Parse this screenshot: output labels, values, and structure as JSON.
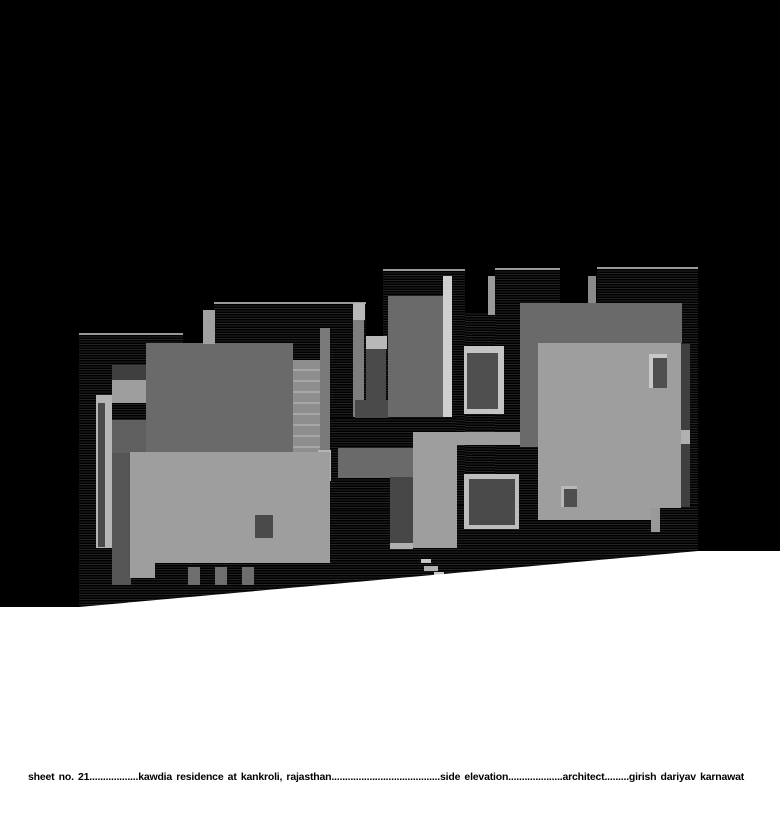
{
  "title_block": {
    "text": "sheet no. 21..................kawdia residence at kankroli, rajasthan........................................side elevation....................architect.........girish dariyav karnawat",
    "sheet_label": "sheet no. 21",
    "project": "kawdia residence at kankroli, rajasthan",
    "view": "side elevation",
    "role_label": "architect",
    "architect_name": "girish dariyav karnawat"
  },
  "drawing": {
    "colors": {
      "background": "#000000",
      "edge": "#9a9a9a",
      "ground_white": "#ffffff",
      "mid_gray": "#6a6a6a",
      "light_gray": "#9e9e9e",
      "lighter_gray": "#b5b5b5",
      "bright_gray": "#cfcfcf",
      "dark_gray": "#4a4a4a"
    },
    "ground": {
      "color": "#ffffff",
      "polygon": "polygon(0px 607px, 79px 607px, 698px 551px, 780px 551px, 780px 813px, 0px 813px)"
    },
    "shapes": [
      {
        "name": "hatched-tower-left",
        "type": "hatch",
        "x": 79,
        "y": 333,
        "w": 104,
        "h": 279,
        "topline": true
      },
      {
        "name": "hatched-tower-midleft",
        "type": "hatch",
        "x": 214,
        "y": 302,
        "w": 152,
        "h": 310,
        "topline": true
      },
      {
        "name": "hatched-tower-central",
        "type": "hatch",
        "x": 383,
        "y": 269,
        "w": 82,
        "h": 343,
        "topline": true
      },
      {
        "name": "hatched-infill-central-gap",
        "type": "hatch",
        "x": 465,
        "y": 312,
        "w": 30,
        "h": 300
      },
      {
        "name": "hatched-tower-right-a",
        "type": "hatch",
        "x": 495,
        "y": 268,
        "w": 65,
        "h": 344,
        "topline": true
      },
      {
        "name": "hatched-tower-right-b",
        "type": "hatch",
        "x": 597,
        "y": 267,
        "w": 101,
        "h": 345,
        "topline": true
      },
      {
        "name": "hatched-base",
        "type": "hatch",
        "x": 79,
        "y": 505,
        "w": 619,
        "h": 107
      },
      {
        "name": "hatched-infill-center-low",
        "type": "hatch",
        "x": 330,
        "y": 418,
        "w": 127,
        "h": 92
      },
      {
        "name": "left-upper-face",
        "x": 146,
        "y": 343,
        "w": 147,
        "h": 110,
        "color": "#6a6a6a"
      },
      {
        "name": "left-dark-panel",
        "x": 112,
        "y": 365,
        "w": 34,
        "h": 15,
        "color": "#3f3f3f"
      },
      {
        "name": "left-light-panel",
        "x": 112,
        "y": 380,
        "w": 34,
        "h": 23,
        "color": "#9e9e9e"
      },
      {
        "name": "left-mid-panel",
        "x": 112,
        "y": 420,
        "w": 34,
        "h": 33,
        "color": "#5f5f5f"
      },
      {
        "name": "left-column",
        "x": 112,
        "y": 453,
        "w": 19,
        "h": 132,
        "color": "#555555"
      },
      {
        "name": "left-light-bar",
        "x": 96,
        "y": 395,
        "w": 16,
        "h": 153,
        "color": "#b5b5b5"
      },
      {
        "name": "left-dark-slit",
        "x": 98,
        "y": 403,
        "w": 7,
        "h": 144,
        "color": "#4a4a4a"
      },
      {
        "name": "parapet-column",
        "x": 203,
        "y": 310,
        "w": 12,
        "h": 34,
        "color": "#a0a0a0"
      },
      {
        "name": "stair-stringer",
        "x": 320,
        "y": 328,
        "w": 10,
        "h": 124,
        "color": "#7a7a7a"
      },
      {
        "name": "staircase",
        "type": "stairs",
        "x": 293,
        "y": 360,
        "w": 27,
        "h": 92
      },
      {
        "name": "stair-light-bar",
        "x": 318,
        "y": 450,
        "w": 13,
        "h": 31,
        "color": "#b5b5b5"
      },
      {
        "name": "lower-slab",
        "x": 133,
        "y": 452,
        "w": 197,
        "h": 111,
        "color": "#9e9e9e"
      },
      {
        "name": "lower-slab-left-wing",
        "x": 130,
        "y": 452,
        "w": 25,
        "h": 126,
        "color": "#9e9e9e"
      },
      {
        "name": "slab-window",
        "x": 255,
        "y": 515,
        "w": 18,
        "h": 23,
        "color": "#4a4a4a"
      },
      {
        "name": "center-mid-block",
        "x": 338,
        "y": 448,
        "w": 75,
        "h": 30,
        "color": "#6a6a6a"
      },
      {
        "name": "center-door",
        "x": 390,
        "y": 477,
        "w": 23,
        "h": 66,
        "color": "#474747"
      },
      {
        "name": "center-door-sill",
        "x": 390,
        "y": 543,
        "w": 23,
        "h": 6,
        "color": "#b0b0b0"
      },
      {
        "name": "base-post-1",
        "x": 188,
        "y": 567,
        "w": 12,
        "h": 18,
        "color": "#6e6e6e"
      },
      {
        "name": "base-post-2",
        "x": 215,
        "y": 567,
        "w": 12,
        "h": 18,
        "color": "#6e6e6e"
      },
      {
        "name": "base-post-3",
        "x": 242,
        "y": 567,
        "w": 12,
        "h": 18,
        "color": "#6e6e6e"
      },
      {
        "name": "pier-cap",
        "x": 353,
        "y": 303,
        "w": 12,
        "h": 17,
        "color": "#b8b8b8"
      },
      {
        "name": "pier-shaft",
        "x": 353,
        "y": 320,
        "w": 11,
        "h": 97,
        "color": "#7e7e7e"
      },
      {
        "name": "slot-window-cap",
        "x": 366,
        "y": 336,
        "w": 21,
        "h": 13,
        "color": "#b8b8b8"
      },
      {
        "name": "slot-window",
        "x": 366,
        "y": 349,
        "w": 20,
        "h": 69,
        "color": "#4a4a4a"
      },
      {
        "name": "center-dark-ledge",
        "x": 355,
        "y": 400,
        "w": 33,
        "h": 18,
        "color": "#4a4a4a"
      },
      {
        "name": "central-tower-face",
        "x": 388,
        "y": 296,
        "w": 55,
        "h": 121,
        "color": "#6a6a6a"
      },
      {
        "name": "central-bright-strip",
        "x": 443,
        "y": 276,
        "w": 9,
        "h": 141,
        "color": "#cfcfcf"
      },
      {
        "name": "gap-pilaster",
        "x": 488,
        "y": 276,
        "w": 7,
        "h": 39,
        "color": "#9a9a9a"
      },
      {
        "name": "right-gap-column",
        "x": 588,
        "y": 276,
        "w": 8,
        "h": 27,
        "color": "#8a8a8a"
      },
      {
        "name": "right-mid-face",
        "x": 520,
        "y": 303,
        "w": 162,
        "h": 40,
        "color": "#6a6a6a"
      },
      {
        "name": "right-mid-face-ext",
        "x": 520,
        "y": 343,
        "w": 18,
        "h": 104,
        "color": "#6a6a6a"
      },
      {
        "name": "center-light-band",
        "x": 413,
        "y": 432,
        "w": 107,
        "h": 13,
        "color": "#9e9e9e"
      },
      {
        "name": "center-light-column",
        "x": 413,
        "y": 432,
        "w": 44,
        "h": 116,
        "color": "#9e9e9e"
      },
      {
        "name": "right-light-face",
        "x": 538,
        "y": 343,
        "w": 143,
        "h": 165,
        "color": "#9e9e9e"
      },
      {
        "name": "right-light-step",
        "x": 538,
        "y": 508,
        "w": 113,
        "h": 12,
        "color": "#9e9e9e"
      },
      {
        "name": "right-light-tab",
        "x": 651,
        "y": 508,
        "w": 9,
        "h": 24,
        "color": "#999999"
      },
      {
        "name": "right-edge-strip",
        "x": 681,
        "y": 344,
        "w": 9,
        "h": 163,
        "color": "#3f3f3f"
      },
      {
        "name": "right-edge-strip-light",
        "x": 681,
        "y": 430,
        "w": 9,
        "h": 14,
        "color": "#b0b0b0"
      },
      {
        "name": "right-door-frame",
        "x": 649,
        "y": 354,
        "w": 18,
        "h": 34,
        "color": "#c8c8c8"
      },
      {
        "name": "right-door",
        "x": 653,
        "y": 358,
        "w": 14,
        "h": 30,
        "color": "#4f4f4f"
      },
      {
        "name": "upper-window-frame",
        "x": 464,
        "y": 346,
        "w": 40,
        "h": 68,
        "color": "#c4c4c4"
      },
      {
        "name": "upper-window",
        "x": 467,
        "y": 353,
        "w": 31,
        "h": 56,
        "color": "#4f4f4f"
      },
      {
        "name": "big-square-window-frame",
        "x": 464,
        "y": 474,
        "w": 55,
        "h": 55,
        "color": "#bcbcbc"
      },
      {
        "name": "big-square-window",
        "x": 469,
        "y": 479,
        "w": 46,
        "h": 46,
        "color": "#4a4a4a"
      },
      {
        "name": "small-window-frame",
        "x": 561,
        "y": 486,
        "w": 16,
        "h": 21,
        "color": "#b8b8b8"
      },
      {
        "name": "small-window",
        "x": 564,
        "y": 489,
        "w": 13,
        "h": 18,
        "color": "#4f4f4f"
      },
      {
        "name": "ground-step-1",
        "x": 421,
        "y": 559,
        "w": 10,
        "h": 4,
        "color": "#c8c8c8"
      },
      {
        "name": "ground-step-2",
        "x": 424,
        "y": 566,
        "w": 14,
        "h": 5,
        "color": "#b0b0b0"
      },
      {
        "name": "ground-step-3",
        "x": 434,
        "y": 572,
        "w": 10,
        "h": 4,
        "color": "#c8c8c8"
      }
    ]
  }
}
